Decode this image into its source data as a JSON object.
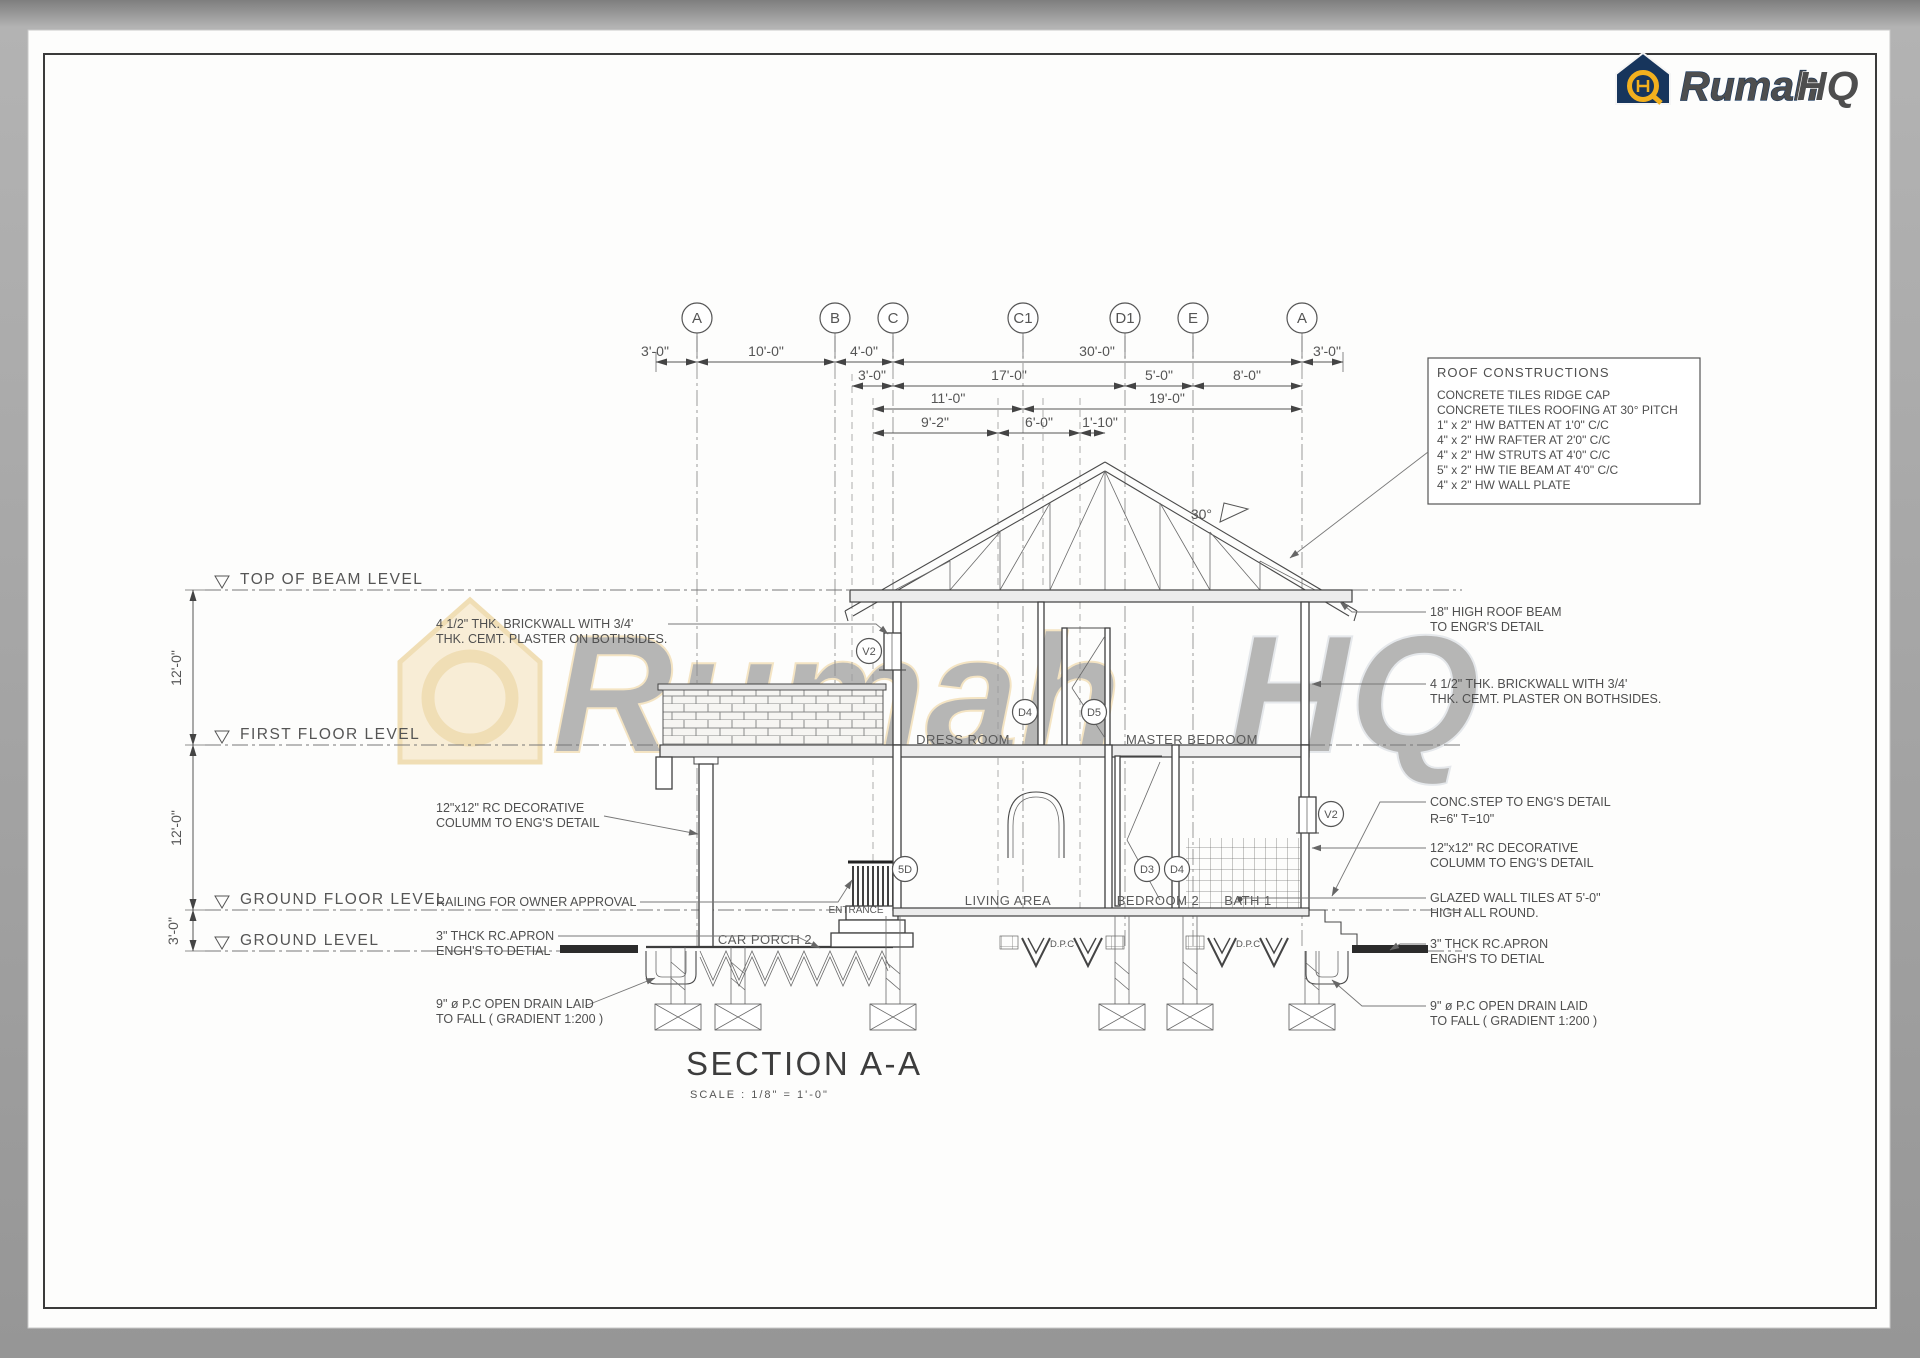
{
  "brand": {
    "name": "Rumah",
    "suffix": "HQ"
  },
  "watermark": {
    "name": "Rumah",
    "suffix": "HQ"
  },
  "grid": {
    "bubbles": [
      "A",
      "B",
      "C",
      "C1",
      "D1",
      "E",
      "A"
    ]
  },
  "dims": {
    "row1": [
      "3'-0\"",
      "10'-0\"",
      "4'-0\"",
      "30'-0\"",
      "3'-0\""
    ],
    "row2": [
      "3'-0\"",
      "17'-0\"",
      "5'-0\"",
      "8'-0\""
    ],
    "row3": [
      "11'-0\"",
      "19'-0\""
    ],
    "row4": [
      "9'-2\"",
      "6'-0\"",
      "1'-10\""
    ],
    "vertical": [
      "12'-0\"",
      "12'-0\"",
      "3'-0\""
    ]
  },
  "levels": [
    "TOP OF BEAM LEVEL",
    "FIRST FLOOR  LEVEL",
    "GROUND FLOOR  LEVEL",
    "GROUND LEVEL"
  ],
  "rooms": {
    "upper": [
      "DRESS ROOM",
      "MASTER BEDROOM"
    ],
    "ground": [
      "ENTRANCE",
      "CAR PORCH 2",
      "LIVING AREA",
      "BEDROOM 2",
      "BATH 1"
    ]
  },
  "tags": [
    "V2",
    "D4",
    "D5",
    "5D",
    "D3",
    "D4",
    "V2"
  ],
  "roof_note": {
    "pitch": "30°"
  },
  "roof_box": {
    "title": "ROOF CONSTRUCTIONS",
    "items": [
      "CONCRETE TILES RIDGE CAP",
      "CONCRETE TILES ROOFING AT 30° PITCH",
      "1\" x 2\" HW BATTEN AT 1'0\" C/C",
      "4\" x 2\" HW RAFTER AT 2'0\" C/C",
      "4\" x 2\" HW STRUTS AT 4'0\" C/C",
      "5\" x 2\" HW TIE BEAM AT 4'0\" C/C",
      "4\" x 2\" HW WALL PLATE"
    ]
  },
  "annotations_left": [
    {
      "lines": [
        "4 1/2\" THK. BRICKWALL WITH 3/4'",
        "THK. CEMT. PLASTER  ON BOTHSIDES."
      ]
    },
    {
      "lines": [
        "12\"x12\" RC DECORATIVE",
        "COLUMM TO ENG'S DETAIL"
      ]
    },
    {
      "lines": [
        "RAILING FOR OWNER APPROVAL"
      ]
    },
    {
      "lines": [
        "3\" THCK RC.APRON",
        "ENGH'S TO DETIAL"
      ]
    },
    {
      "lines": [
        "9\" ø P.C OPEN DRAIN LAID",
        "TO FALL ( GRADIENT 1:200 )"
      ]
    }
  ],
  "annotations_right": [
    {
      "lines": [
        "18\" HIGH ROOF BEAM",
        "TO ENGR'S DETAIL"
      ]
    },
    {
      "lines": [
        "4 1/2\" THK. BRICKWALL WITH 3/4'",
        "THK. CEMT. PLASTER  ON BOTHSIDES."
      ]
    },
    {
      "lines": [
        "CONC.STEP TO ENG'S DETAIL",
        "R=6\" T=10\""
      ]
    },
    {
      "lines": [
        "12\"x12\" RC DECORATIVE",
        "COLUMM TO ENG'S DETAIL"
      ]
    },
    {
      "lines": [
        "GLAZED WALL TILES AT 5'-0\"",
        "HIGH ALL ROUND."
      ]
    },
    {
      "lines": [
        "3\" THCK RC.APRON",
        "ENGH'S TO DETIAL"
      ]
    },
    {
      "lines": [
        "9\" ø P.C OPEN DRAIN LAID",
        "TO FALL ( GRADIENT 1:200 )"
      ]
    }
  ],
  "dpc_label": "D.P.C",
  "section": {
    "title": "SECTION A-A",
    "scale": "SCALE : 1/8\" = 1'-0\""
  }
}
